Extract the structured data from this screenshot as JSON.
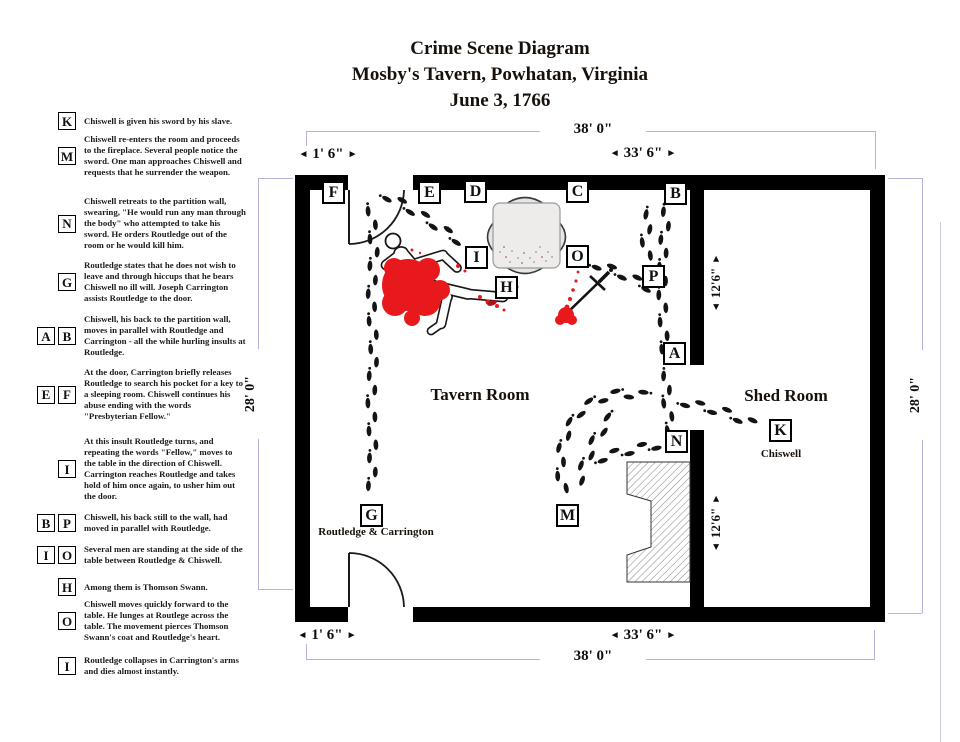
{
  "title": {
    "line1": "Crime Scene Diagram",
    "line2": "Mosby's Tavern, Powhatan, Virginia",
    "line3": "June 3, 1766"
  },
  "icons": {
    "arrow_left": "◄",
    "arrow_right": "►"
  },
  "colors": {
    "blood": "#e8191d",
    "blood_dark": "#b01016",
    "wall": "#000000",
    "dimension_line": "#b3b3dd",
    "footprint": "#141414"
  },
  "legend": [
    {
      "letters": [
        "K"
      ],
      "text": "Chiswell is given his sword by his slave."
    },
    {
      "letters": [
        "M"
      ],
      "text": "Chiswell re-enters the room and proceeds to the fireplace. Several people notice the sword. One man approaches Chiswell and requests that he surrender the weapon."
    },
    {
      "letters": [
        "N"
      ],
      "text": "Chiswell retreats to the partition wall, swearing, \"He would run any man through the body\" who attempted to take his sword. He orders Routledge out of the room or he would kill him."
    },
    {
      "letters": [
        "G"
      ],
      "text": "Routledge states that he does not wish to leave and through hiccups that he bears Chiswell no ill will. Joseph Carrington assists Routledge to the door."
    },
    {
      "letters": [
        "A",
        "B"
      ],
      "text": "Chiswell, his back to the partition wall, moves in parallel with Routledge and Carrington - all the while hurling insults at Routledge."
    },
    {
      "letters": [
        "E",
        "F"
      ],
      "text": "At the door, Carrington briefly releases Routledge to search his pocket for a key to a sleeping room. Chiswell continues his abuse ending with the words \"Presbyterian Fellow.\""
    },
    {
      "letters": [
        "I"
      ],
      "text": "At this insult Routledge turns, and repeating the words \"Fellow,\" moves to the table in the direction of Chiswell. Carrington reaches Routledge and takes hold of him once again, to usher him out the door."
    },
    {
      "letters": [
        "B",
        "P"
      ],
      "text": "Chiswell, his back still to the wall, had moved in parallel with Routledge."
    },
    {
      "letters": [
        "I",
        "O"
      ],
      "text": "Several men are standing at the side of the table between Routledge & Chiswell."
    },
    {
      "letters": [
        "H"
      ],
      "text": "Among them is Thomson Swann."
    },
    {
      "letters": [
        "O"
      ],
      "text": "Chiswell moves quickly forward to the table. He lunges at Routlege across the table. The movement pierces Thomson Swann's coat and Routledge's heart."
    },
    {
      "letters": [
        "I"
      ],
      "text": "Routledge collapses in Carrington's arms and dies almost instantly."
    }
  ],
  "rooms": {
    "tavern_label": "Tavern Room",
    "shed_label": "Shed Room"
  },
  "captions": {
    "g_caption": "Routledge & Carrington",
    "k_caption": "Chiswell"
  },
  "dimensions": {
    "top_width": "38' 0\"",
    "bottom_width": "38' 0\"",
    "left_height": "28' 0\"",
    "right_height": "28' 0\"",
    "top_door_offset": "1' 6\"",
    "top_span": "33' 6\"",
    "bottom_door_offset": "1' 6\"",
    "bottom_span": "33' 6\"",
    "shed_upper_height": "12'6\"",
    "shed_lower_height": "12'6\""
  },
  "markers": [
    {
      "letter": "F",
      "x": 334,
      "y": 193
    },
    {
      "letter": "E",
      "x": 430,
      "y": 193
    },
    {
      "letter": "D",
      "x": 476,
      "y": 192
    },
    {
      "letter": "C",
      "x": 578,
      "y": 192
    },
    {
      "letter": "B",
      "x": 676,
      "y": 194
    },
    {
      "letter": "I",
      "x": 477,
      "y": 258
    },
    {
      "letter": "O",
      "x": 578,
      "y": 257
    },
    {
      "letter": "H",
      "x": 507,
      "y": 288
    },
    {
      "letter": "P",
      "x": 654,
      "y": 277
    },
    {
      "letter": "A",
      "x": 675,
      "y": 354
    },
    {
      "letter": "N",
      "x": 677,
      "y": 442
    },
    {
      "letter": "K",
      "x": 781,
      "y": 431
    },
    {
      "letter": "G",
      "x": 372,
      "y": 516
    },
    {
      "letter": "M",
      "x": 568,
      "y": 516
    }
  ],
  "trails": [
    {
      "name": "routledge-to-table",
      "points": [
        [
          384,
          194
        ],
        [
          406,
          206
        ],
        [
          430,
          221
        ],
        [
          452,
          236
        ],
        [
          468,
          246
        ]
      ]
    },
    {
      "name": "to-lower-door",
      "points": [
        [
          371,
          206
        ],
        [
          374,
          252
        ],
        [
          371,
          300
        ],
        [
          374,
          350
        ],
        [
          371,
          400
        ],
        [
          373,
          452
        ],
        [
          371,
          499
        ]
      ]
    },
    {
      "name": "chiswell-wall-b-to-a",
      "points": [
        [
          667,
          207
        ],
        [
          663,
          250
        ],
        [
          662,
          295
        ],
        [
          664,
          338
        ],
        [
          666,
          360
        ]
      ]
    },
    {
      "name": "chiswell-wall-b-to-p",
      "points": [
        [
          650,
          210
        ],
        [
          645,
          238
        ],
        [
          648,
          263
        ]
      ]
    },
    {
      "name": "o-to-p",
      "points": [
        [
          593,
          263
        ],
        [
          615,
          271
        ],
        [
          637,
          281
        ],
        [
          650,
          288
        ]
      ]
    },
    {
      "name": "a-to-n",
      "points": [
        [
          667,
          371
        ],
        [
          666,
          396
        ],
        [
          669,
          420
        ],
        [
          671,
          433
        ]
      ]
    },
    {
      "name": "to-shed-k",
      "points": [
        [
          681,
          401
        ],
        [
          703,
          407
        ],
        [
          724,
          412
        ],
        [
          744,
          420
        ],
        [
          762,
          428
        ]
      ]
    },
    {
      "name": "junction-to-m-outer",
      "points": [
        [
          648,
          396
        ],
        [
          622,
          393
        ],
        [
          597,
          399
        ],
        [
          578,
          413
        ],
        [
          566,
          433
        ],
        [
          560,
          456
        ],
        [
          561,
          479
        ],
        [
          565,
          498
        ]
      ]
    },
    {
      "name": "inner-arc-to-m",
      "points": [
        [
          613,
          415
        ],
        [
          597,
          436
        ],
        [
          587,
          458
        ],
        [
          579,
          480
        ]
      ]
    },
    {
      "name": "to-n-door",
      "points": [
        [
          597,
          459
        ],
        [
          621,
          452
        ],
        [
          646,
          447
        ],
        [
          661,
          444
        ]
      ]
    }
  ],
  "table_speckles": [
    [
      500,
      252,
      0
    ],
    [
      506,
      257,
      1
    ],
    [
      512,
      251,
      0
    ],
    [
      518,
      258,
      0
    ],
    [
      524,
      253,
      1
    ],
    [
      530,
      258,
      0
    ],
    [
      536,
      252,
      0
    ],
    [
      542,
      257,
      1
    ],
    [
      548,
      252,
      0
    ],
    [
      510,
      262,
      0
    ],
    [
      522,
      263,
      1
    ],
    [
      534,
      262,
      0
    ],
    [
      546,
      261,
      0
    ],
    [
      504,
      247,
      1
    ],
    [
      540,
      247,
      0
    ],
    [
      552,
      257,
      0
    ]
  ]
}
